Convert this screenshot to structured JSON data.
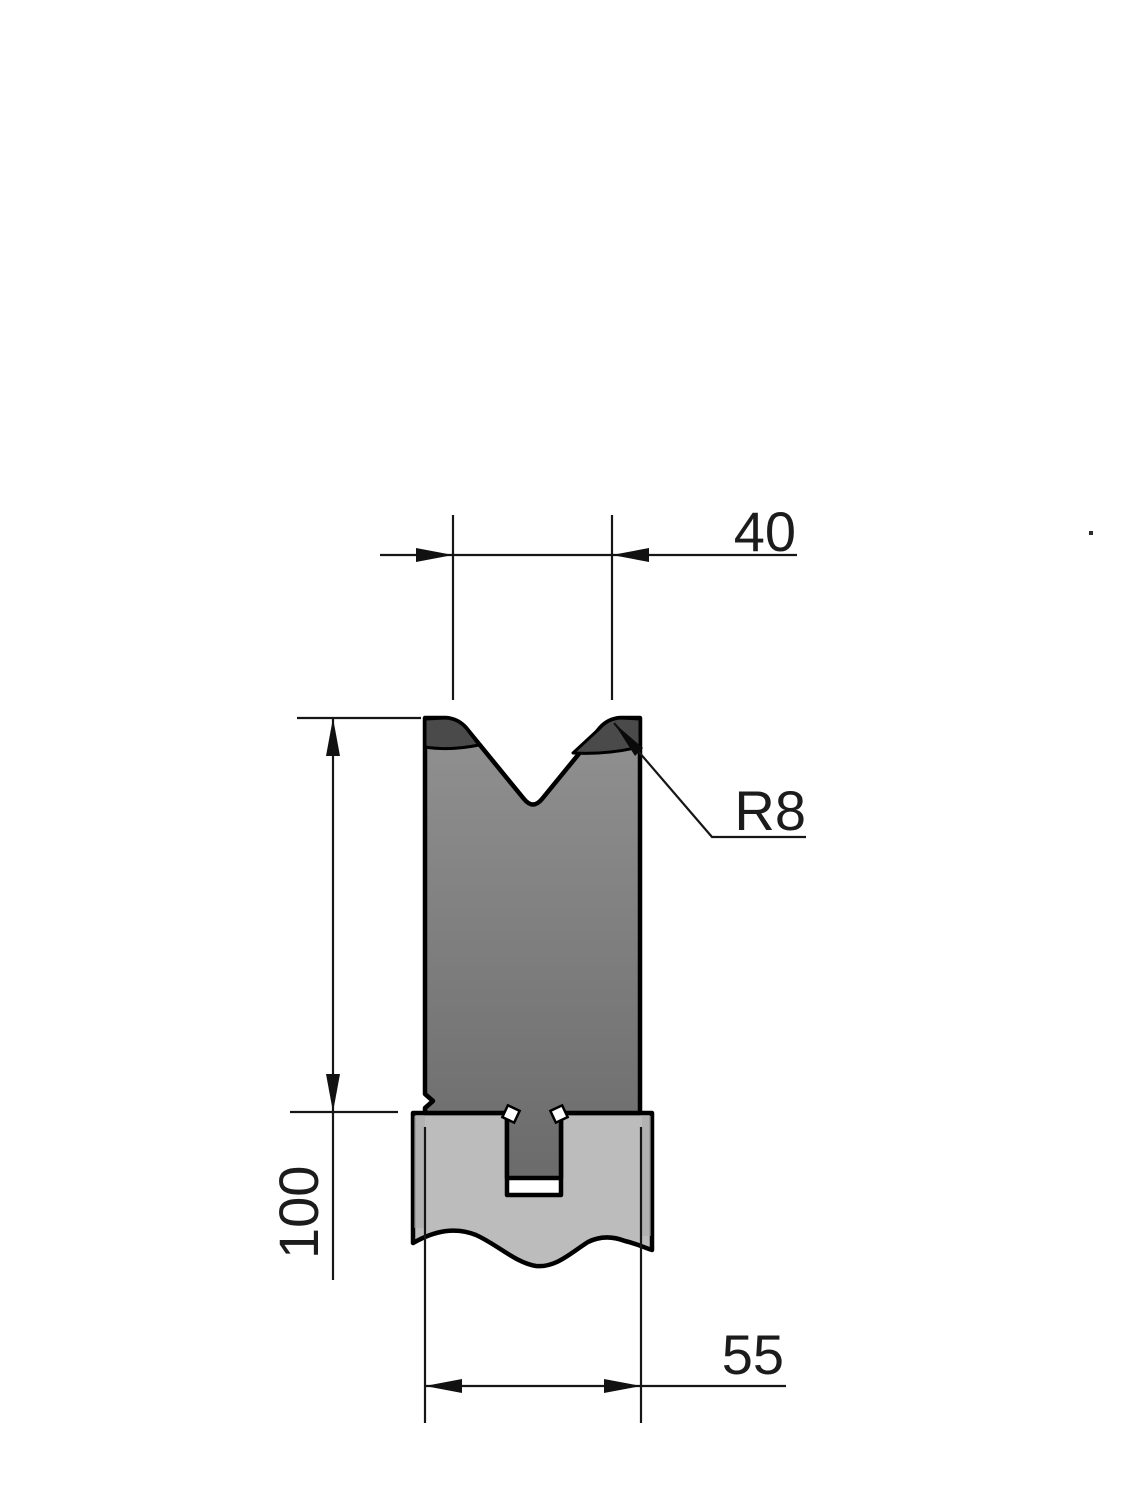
{
  "drawing": {
    "type": "technical-drawing",
    "subject": "press-brake V-die cross-section with die holder",
    "dimensions": {
      "top_width": "40",
      "radius_callout": "R8",
      "height": "100",
      "bottom_width": "55"
    },
    "colors": {
      "background": "#ffffff",
      "outline": "#000000",
      "dim_line": "#161616",
      "text": "#1c1c1c",
      "die_top": "#919191",
      "die_bottom": "#6b6b6b",
      "dark_band": "#4a4a4a",
      "holder": "#bcbcbc",
      "holder_chamfer": "#a9a9a9",
      "slot_gap": "#ffffff"
    }
  }
}
